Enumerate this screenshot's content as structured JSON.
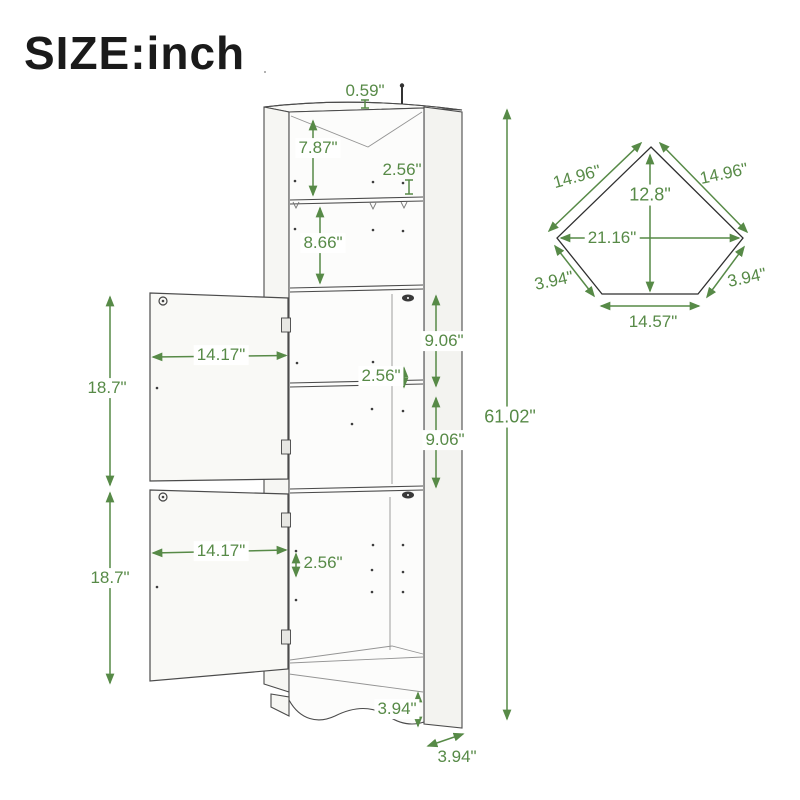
{
  "title": "SIZE:inch",
  "unit": "inch",
  "colors": {
    "dimension_green": "#578a47",
    "line_gray": "#4b4b4b",
    "title_color": "#1a1a1a"
  },
  "front_view": {
    "name": "corner cabinet front view",
    "dimensions": {
      "top_panel_thickness": "0.59\"",
      "top_compartment_height": "7.87\"",
      "top_shelf_spacing": "2.56\"",
      "second_compartment_height": "8.66\"",
      "upper_door_width": "14.17\"",
      "upper_door_height": "18.7\"",
      "upper_middle_compartment_height": "9.06\"",
      "middle_shelf_spacing": "2.56\"",
      "lower_middle_compartment_height": "9.06\"",
      "overall_height": "61.02\"",
      "lower_door_width": "14.17\"",
      "lower_door_height": "18.7\"",
      "lower_shelf_spacing": "2.56\"",
      "base_height": "3.94\"",
      "side_panel_depth": "3.94\""
    }
  },
  "top_view": {
    "name": "corner cabinet top view",
    "dimensions": {
      "back_left_edge": "14.96\"",
      "back_right_edge": "14.96\"",
      "depth_front_to_back": "12.8\"",
      "overall_width": "21.16\"",
      "front_left_edge": "3.94\"",
      "front_right_edge": "3.94\"",
      "front_edge_width": "14.57\""
    }
  }
}
